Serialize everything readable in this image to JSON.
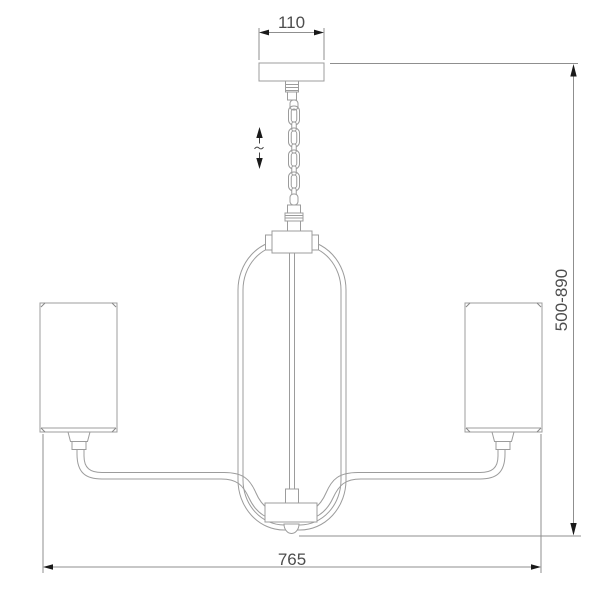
{
  "drawing": {
    "type": "chandelier-dimension-diagram",
    "dimensions": {
      "canopy_width": "110",
      "height_range": "500-890",
      "total_width": "765"
    },
    "colors": {
      "line": "#9c9c9c",
      "dim_line": "#8f8f8f",
      "text_color": "#4d4d4d",
      "arrow": "#1a1a1a",
      "bg": "#ffffff"
    }
  }
}
